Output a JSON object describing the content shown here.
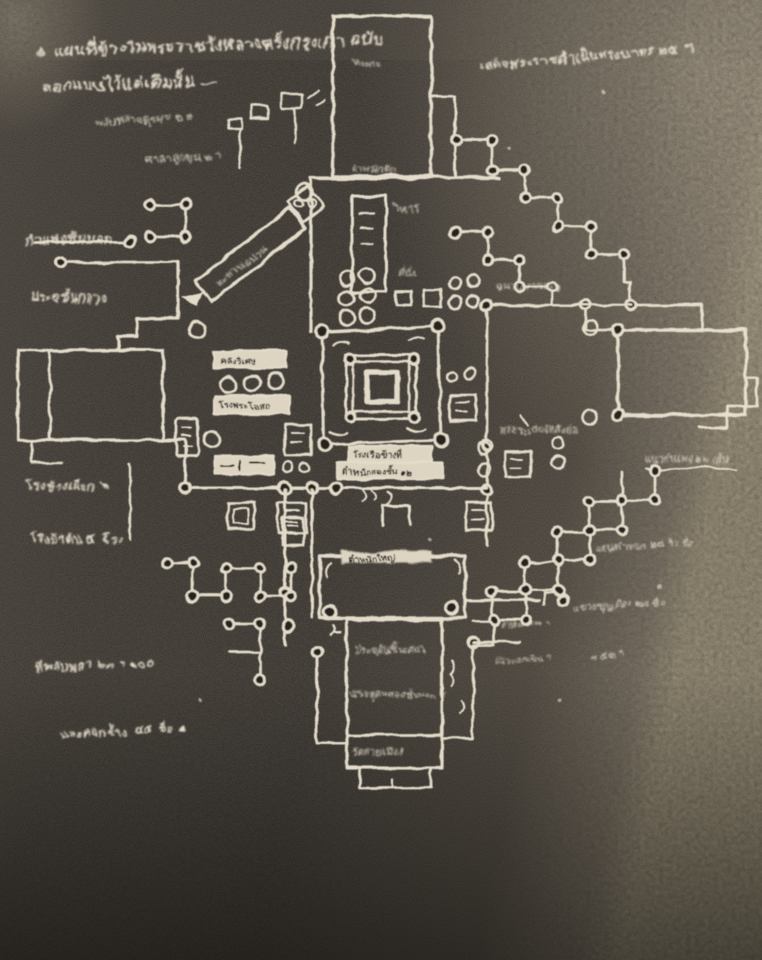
{
  "photo": {
    "description_colors": {
      "paper_dark": "#2b2723",
      "paper_mid": "#3a352f",
      "paper_light": "#8d8270",
      "ink": "#ece4d2"
    },
    "caption": {
      "bullet": "๏",
      "line1": "แผนที่ข้างในพระราชวังหลวงครั้งกรุงเก่า ฉบับ",
      "line2": "ลอกแบบไว้แต่เดิมนั้น —"
    },
    "labels": {
      "upper_left_1": "พลับพลาจตุรมุข ๒ ๙",
      "upper_left_2": "ศาลาลูกขุน ๒ ฯ",
      "top_hall": "หอพระ",
      "procession": "เสด็จพระราชดำเนินทรงบาตร ๒๕ ฯ",
      "top_wall": "ตำหนักตึก",
      "vihara": "วิหาร",
      "outer_wall_left": "กำแพงชั้นนอก",
      "gate_mid_left": "ประตูชั้นกลาง",
      "diagonal_bridge": "สะพานฉนวน",
      "seat": "ที่นั่ง",
      "chanuan": "ฉนวนทางเสด็จ",
      "treasury": "คลังวิเศษ",
      "dispensary": "โรงพระโอสถ",
      "boat_house": "โรงเรือข้างที่",
      "two_storey": "ตำหนักสองชั้น ๑๒",
      "gallery": "พระระเบียงหลังย่อ",
      "outer_wall_right": "แนวกำแพง ๒๖ เส้น",
      "elephant_house": "โรงช้างเผือก ๒",
      "horse_house": "โรงม้าต้น ๔ โรง",
      "main_hall": "ตำหนักใหญ่",
      "raft_pavilion": "ตำหนักแพ ฯ",
      "annex_line1": "ประตูดินชั้นเดียว",
      "annex_line2": "ประตูดินสองชั้นนอก ฯ",
      "annex_line3": "วัดท้ายเมือง",
      "naew_nok": "แนวนอกเขิน ฯ",
      "bottom_left_1": "ที่พลับพลา ๒๓ ฯ ๑๐๐",
      "bottom_left_2": "และคอกช้าง ๔๕ ชื่อ ๑",
      "bottom_right_1": "แสนตำหนัก ๒๘ ริ้ว ชื่อ",
      "bottom_right_2": "แขวงขุนเมือง ๒๕ ชื่อ",
      "bottom_right_3": "ฯ ๕๓ ฯ"
    }
  }
}
